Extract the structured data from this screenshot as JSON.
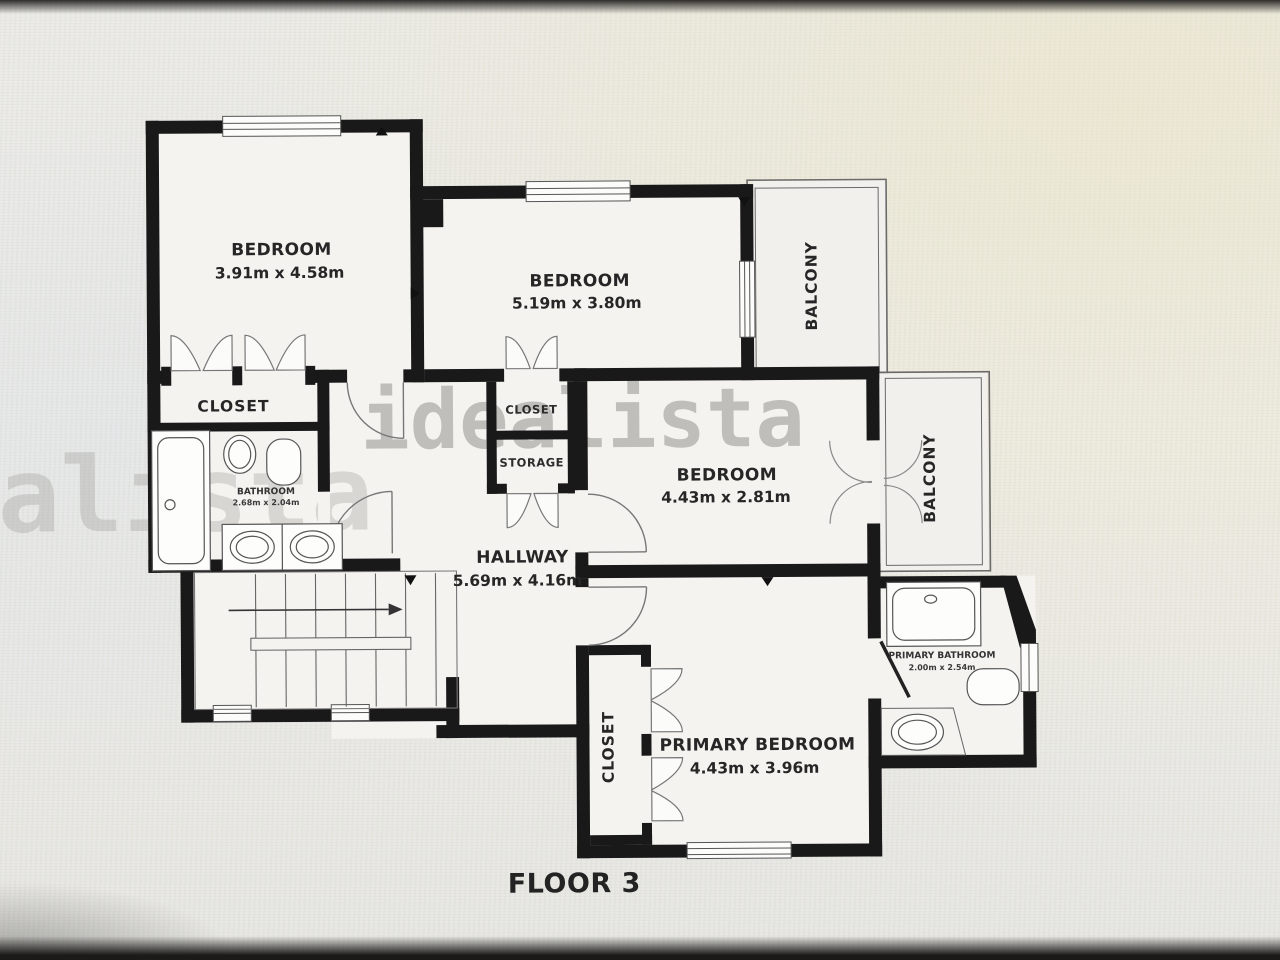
{
  "page": {
    "floor_label": "FLOOR 3",
    "watermark": "idealista"
  },
  "rooms": {
    "bedroom1": {
      "name": "BEDROOM",
      "dims": "3.91m x 4.58m"
    },
    "bedroom2": {
      "name": "BEDROOM",
      "dims": "5.19m x 3.80m"
    },
    "bedroom3": {
      "name": "BEDROOM",
      "dims": "4.43m x 2.81m"
    },
    "primary_bedroom": {
      "name": "PRIMARY BEDROOM",
      "dims": "4.43m x 3.96m"
    },
    "hallway": {
      "name": "HALLWAY",
      "dims": "5.69m x 4.16m"
    },
    "bathroom": {
      "name": "BATHROOM",
      "dims": "2.68m x 2.04m"
    },
    "primary_bathroom": {
      "name": "PRIMARY BATHROOM",
      "dims": "2.00m x 2.54m"
    },
    "closet_left": {
      "name": "CLOSET"
    },
    "closet_middle": {
      "name": "CLOSET"
    },
    "storage": {
      "name": "STORAGE"
    },
    "closet_primary": {
      "name": "CLOSET"
    },
    "balcony_top": {
      "name": "BALCONY"
    },
    "balcony_right": {
      "name": "BALCONY"
    }
  },
  "colors": {
    "wall": "#191919",
    "room_fill": "#f4f3f0",
    "thin_line": "#6a6a6a",
    "watermark": "#8f8e8a",
    "background": "#ecebe7"
  }
}
